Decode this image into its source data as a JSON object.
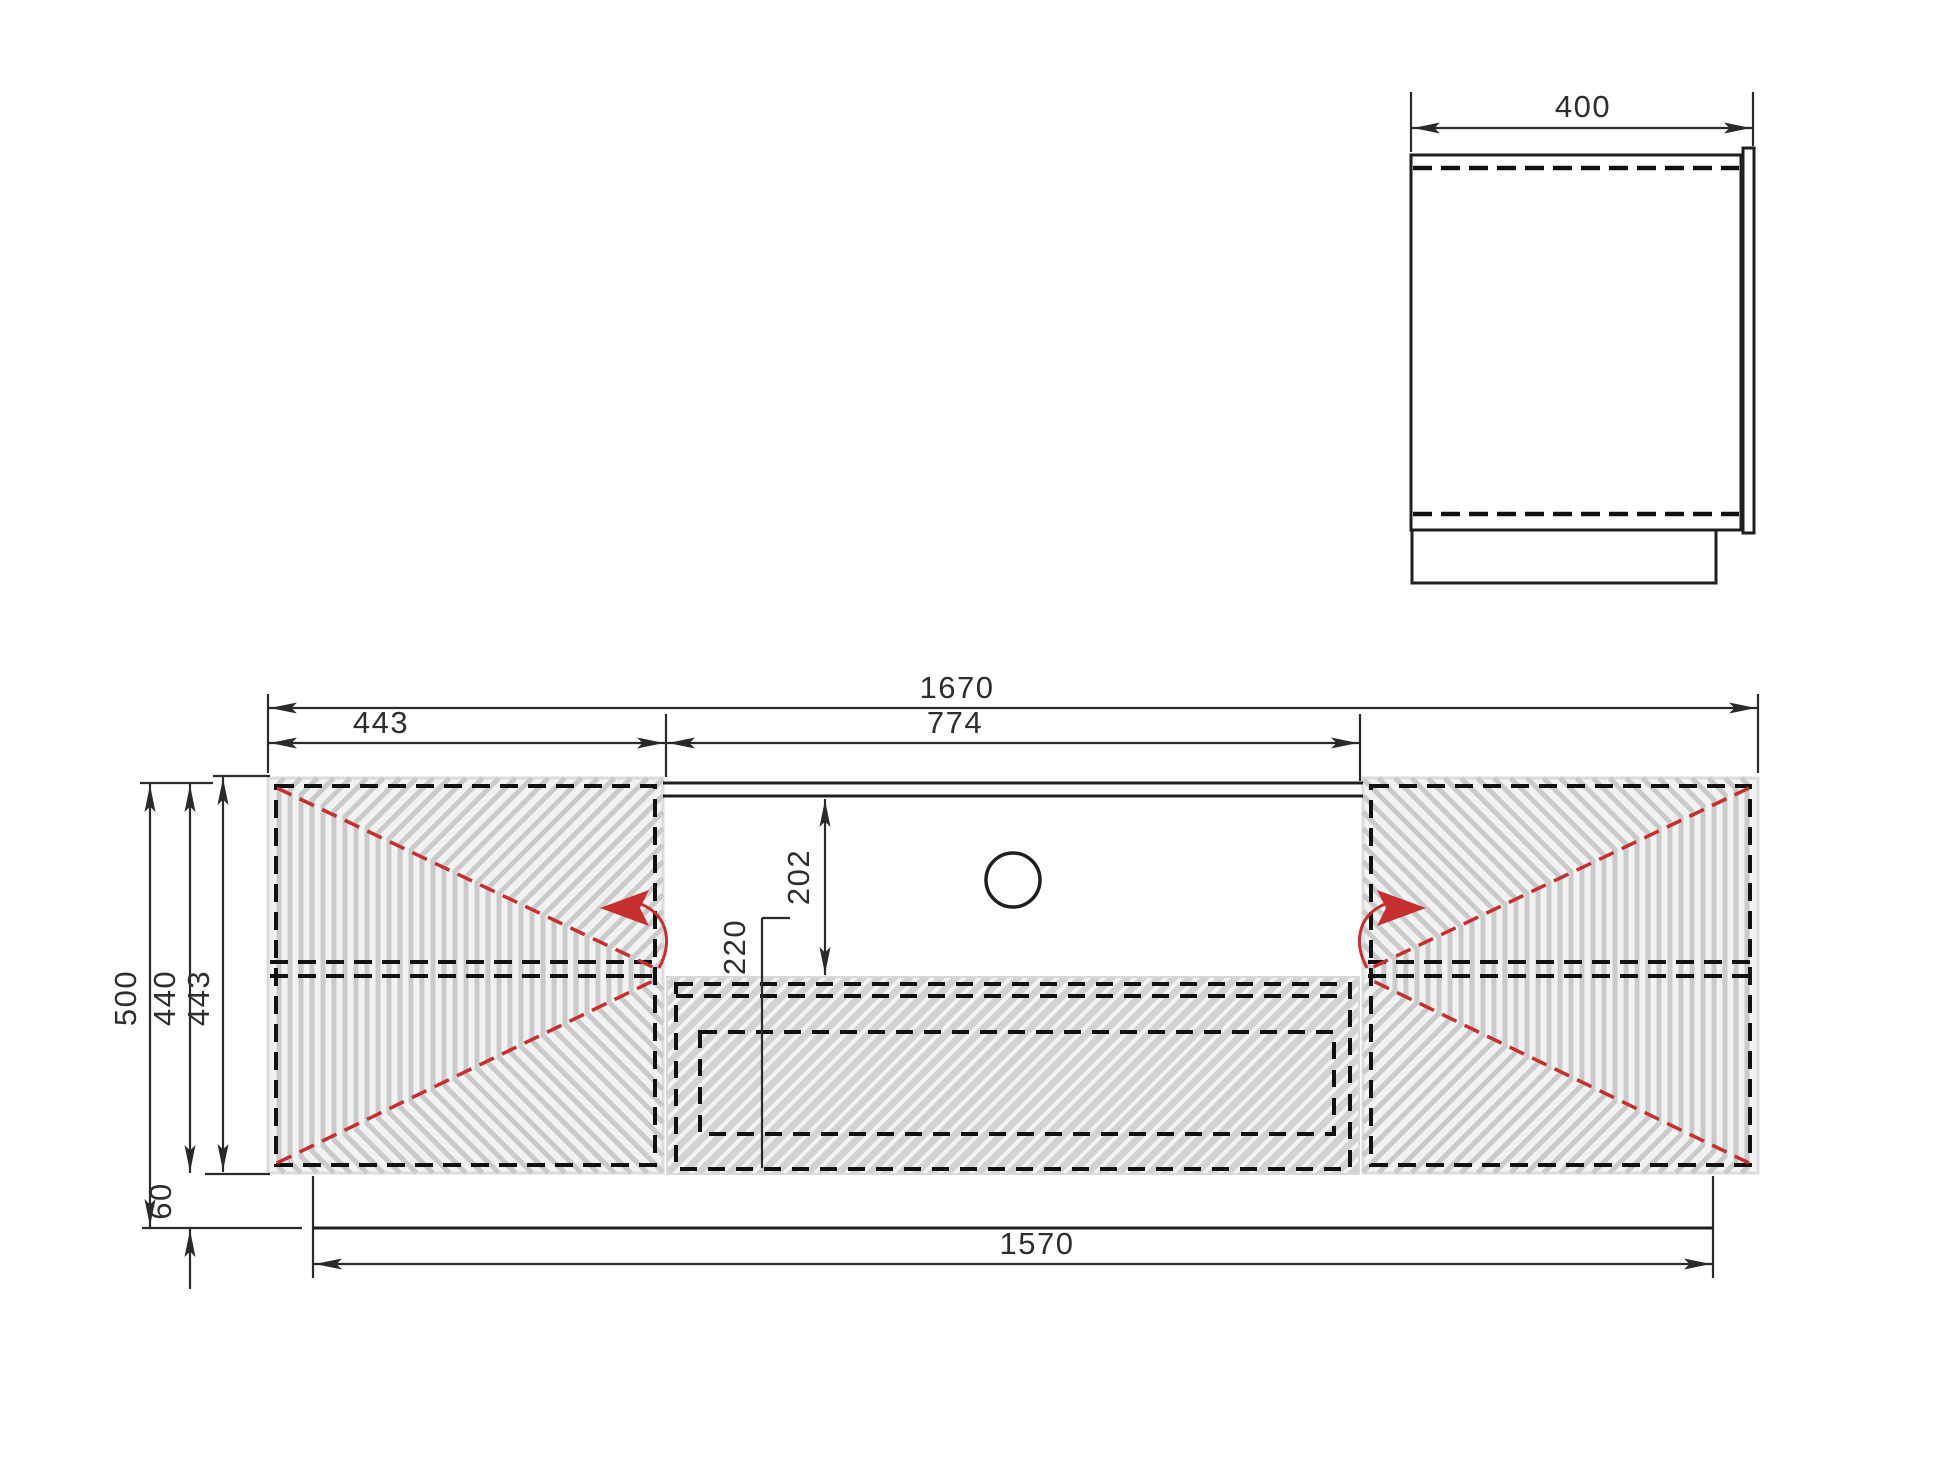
{
  "drawing": {
    "kind": "furniture technical drawing, front and side elevation",
    "views": {
      "side_view": {
        "name": "side-view"
      },
      "front_view": {
        "name": "front-view"
      }
    }
  },
  "dimensions": {
    "depth": "400",
    "total_width": "1670",
    "left_door_width": "443",
    "niche_width": "774",
    "niche_height": "202",
    "drawer_front_height": "220",
    "total_height": "500",
    "carcass_height": "440",
    "door_height": "443",
    "plinth_height": "60",
    "plinth_width": "1570"
  },
  "colors": {
    "outline": "#1f1f1f",
    "hidden_line": "#121212",
    "swing_arrow_red": "#c62f2f",
    "groove_gray": "#cacaca",
    "hatch_gray": "#d2d2d2",
    "panel_bg": "#f2f2f2"
  }
}
